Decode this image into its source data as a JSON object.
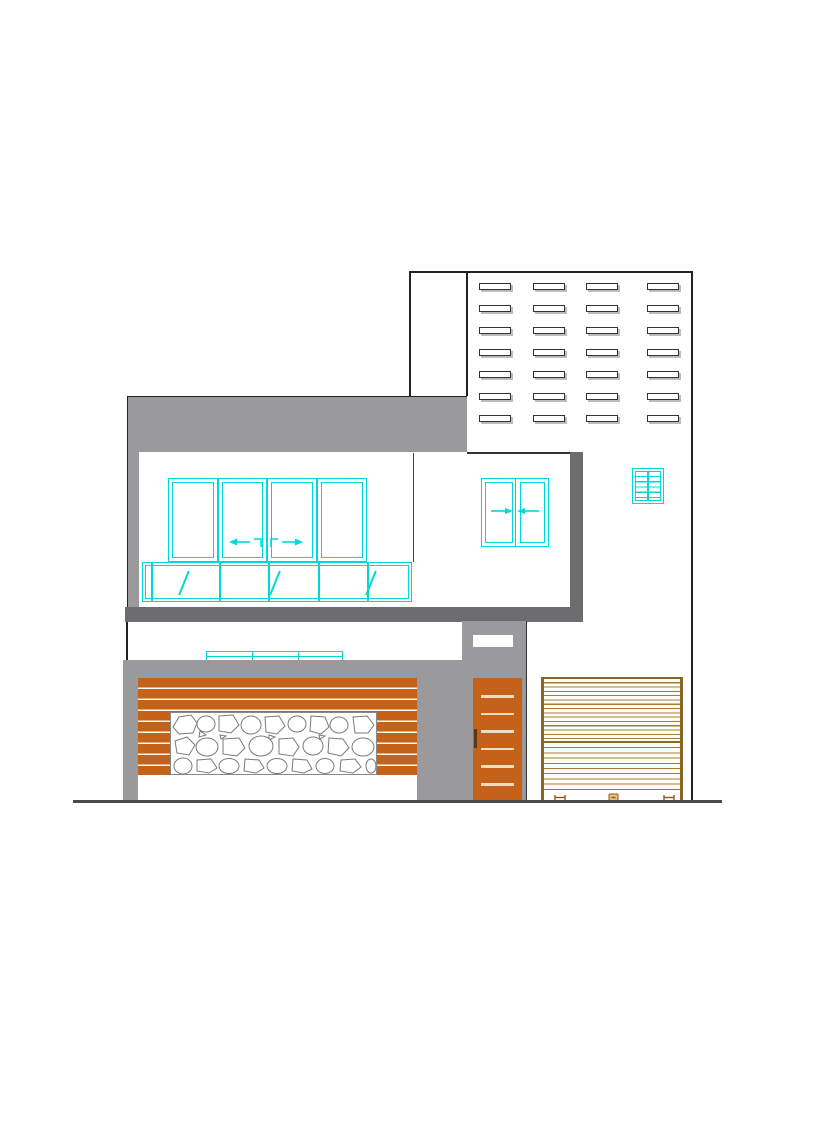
{
  "document": {
    "kind": "architectural-front-elevation-drawing",
    "visible_text": "",
    "background": "#ffffff"
  },
  "colors": {
    "outline": "#222222",
    "cyan": "#00d8d8",
    "wall_gray": "#9a9a9c",
    "dark_gray": "#6d6d6f",
    "orange": "#c4621a",
    "door_stripe": "#f2dcc0",
    "shutter_line": "#a87b33",
    "shutter_rail": "#8a6526",
    "stone_outline": "#7a7a7a",
    "ground": "#4a4a4a"
  },
  "drawing": {
    "jali_vent_grid": {
      "rows": 7,
      "cols": 4,
      "slot_width": 32,
      "slot_height": 7
    },
    "parapet_band": {
      "fill": "gray"
    },
    "main_sliding_window": {
      "panels": 4,
      "symbols": [
        "left-arrow",
        "corner-left",
        "corner-right",
        "right-arrow"
      ]
    },
    "window_lower_band": {
      "cells": 6,
      "fixed_glass_marks": 3
    },
    "two_panel_sliding_window": {
      "panels": 2,
      "symbols": [
        "arrow-to-center-left",
        "arrow-to-center-right"
      ]
    },
    "louver_window": {
      "panels": 2,
      "slats_per_panel": 5
    },
    "courtyard_window_top": {
      "panels": 3
    },
    "compound_gate": {
      "slats": 9,
      "stone_panel": true
    },
    "main_door": {
      "stripes": 6,
      "handle": true,
      "letterbox": true
    },
    "rolling_shutter": {
      "sections": 2,
      "bottom_glyphs": [
        "latch-left",
        "lock",
        "latch-right"
      ]
    },
    "ground_line": true
  }
}
